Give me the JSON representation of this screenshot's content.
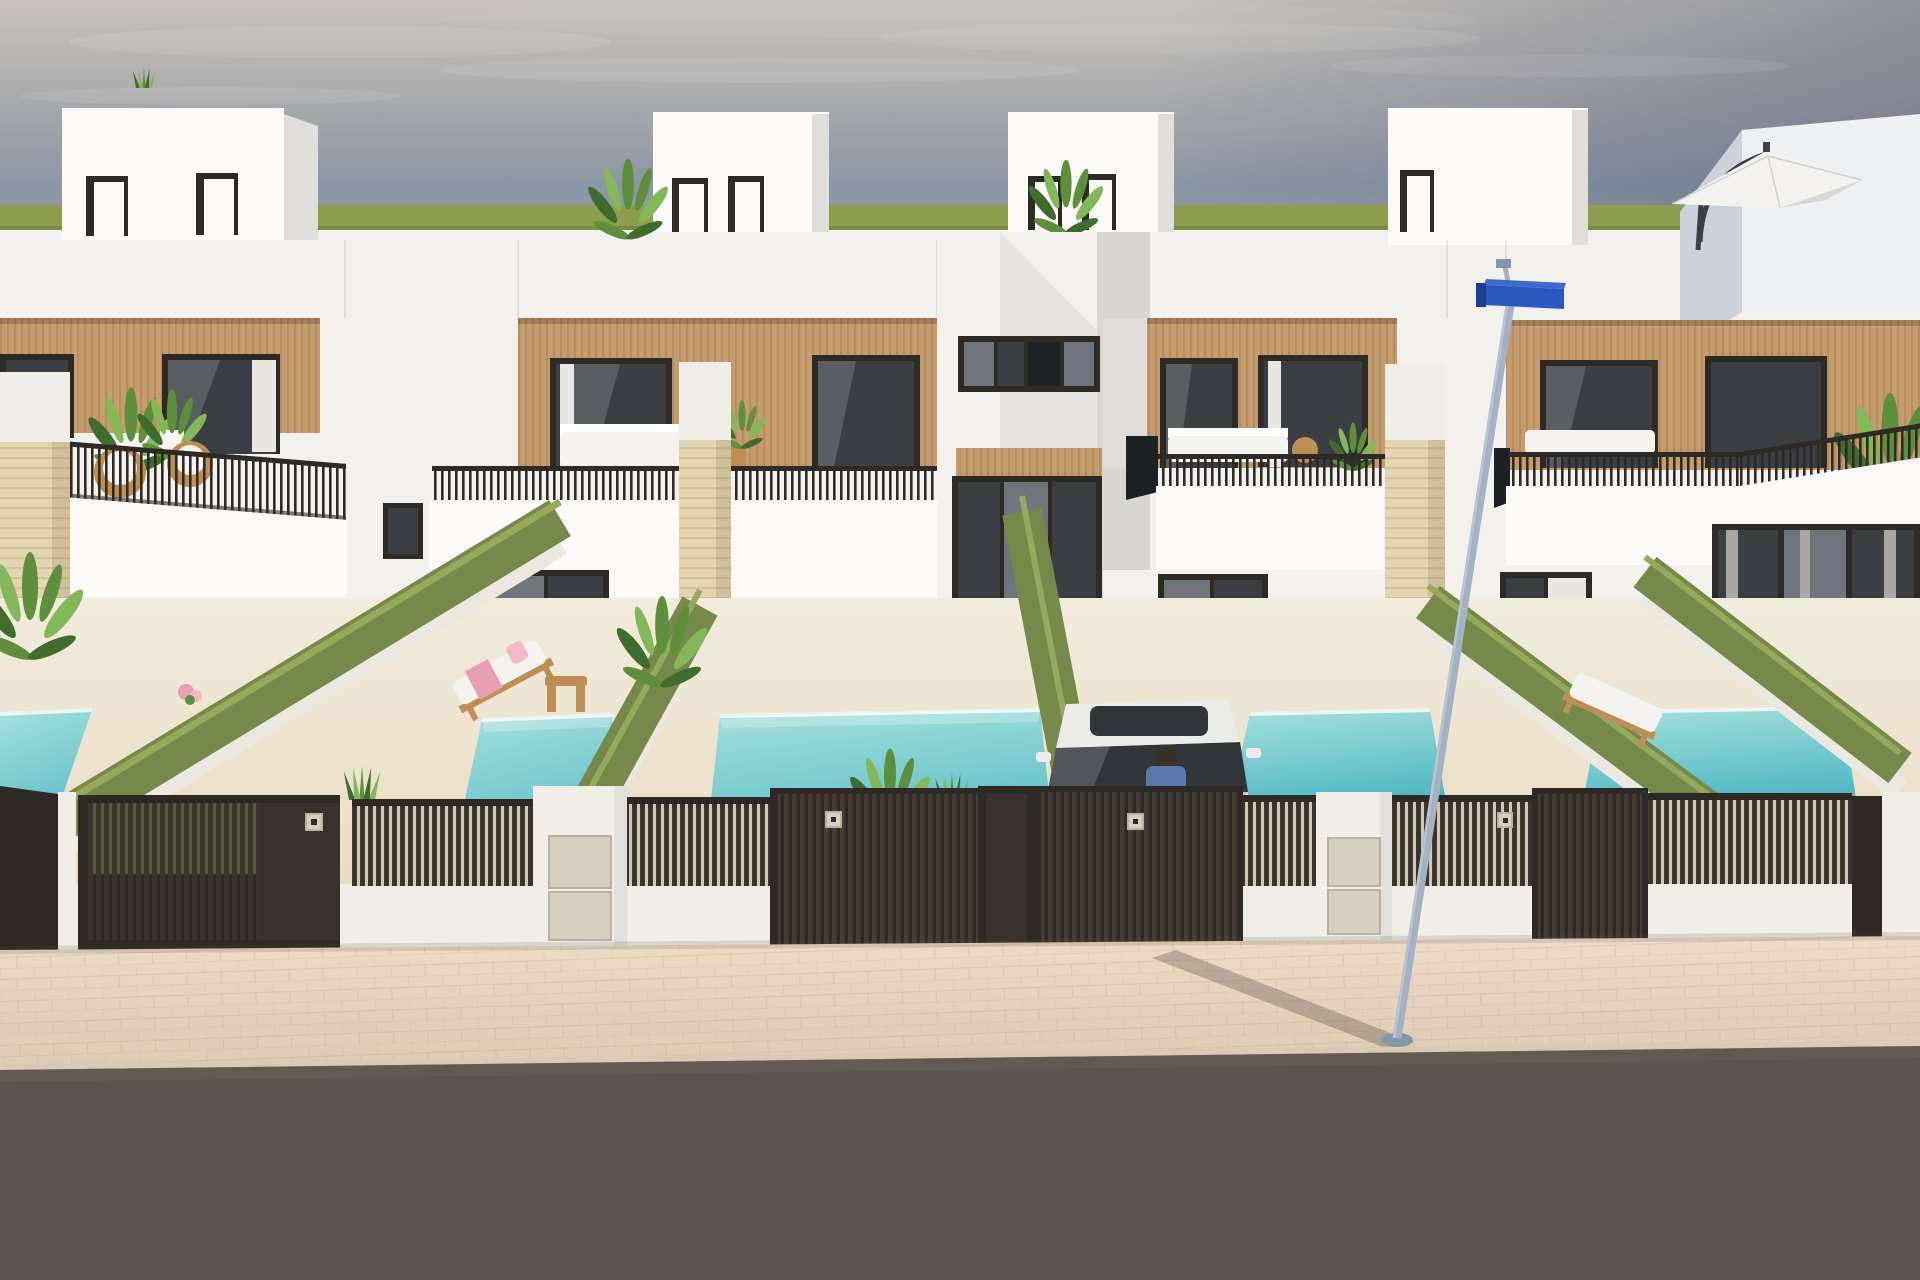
{
  "scene": {
    "type": "architectural-3d-render",
    "subject": "row of modern two-storey white townhouses with wood-clad upper floors, private plunge pools, green hedge walls, dark slat street gates, sidewalk and road in foreground",
    "objects": {
      "townhouses": 4,
      "penthouse_roof_boxes": 4,
      "pools": 5,
      "hedge_walls": 5,
      "stone_pillars": 3,
      "gates": 4,
      "meter_pillars": 2,
      "sun_loungers": 2,
      "car": "white compact with driver",
      "street_lamp": "leaning pole with blue luminaire",
      "umbrella": "white cantilever parasol on right roof terrace"
    }
  },
  "palette": {
    "sky_top": "#c8c3bc",
    "sky_mid": "#a9aaad",
    "sky_low": "#8b95a3",
    "sky_horizon": "#98a1ac",
    "sky_shade": "#4e5a72",
    "cloud": "#eae6e1",
    "grass": "#8d9c4f",
    "grass_dark": "#788c3e",
    "wall": "#f3f1ee",
    "wall_bright": "#fbfaf8",
    "wall_shade": "#e0deda",
    "bay_shade": "#d8d6d3",
    "bulk_face": "#eef0f3",
    "bulk_shade": "#ccd2dc",
    "wood": "#c49c6e",
    "wood_stripe": "#a57e52",
    "frame": "#2e2b27",
    "glass": "#6f757c",
    "glass_dark": "#3b3f44",
    "curtain": "#e9e7e2",
    "curtain_gray": "#a9a7a4",
    "trav": "#e3d5b1",
    "trav_line": "#c9b892",
    "hedge": "#75894a",
    "hedge_hi": "#95a95c",
    "hedge_wall": "#ece8df",
    "pool_hi": "#a7e0dd",
    "pool_lo": "#52b9c4",
    "pool_edge": "#e9f6f3",
    "patio": "#f2ebdc",
    "patio_warm": "#e8dbc2",
    "fence": "#2e2924",
    "fence_slat": "#3b342d",
    "fence_slat_lit": "#463d35",
    "fence_bg": "#cfc8ba",
    "fence_green_bg": "#77855a",
    "pillar_white": "#f1eee8",
    "meter": "#d6cec1",
    "sidewalk": "#ecdcc6",
    "paver": "#c8a87f",
    "road": "#5b534e",
    "curb": "#dbcab3",
    "car": "#ebebe9",
    "car_shade": "#d6d6d4",
    "car_glass": "#32363b",
    "person": "#5a78a8",
    "pole": "#a3b1c3",
    "pole_dark": "#8595a9",
    "lamp_blue": "#2a57c0",
    "lamp_blue_dark": "#1d3f90",
    "umbrella": "#f3f2ef",
    "umbrella_shade": "#d8d8d4",
    "metal_dark": "#3c4046",
    "cushion": "#f4f3f0",
    "wood_furn": "#bf8e55",
    "towel": "#e89fb1",
    "towel_hi": "#f2bac6",
    "amber": "#d9a93e",
    "leaf": "#5d8f3d",
    "leaf_dark": "#406c2d",
    "leaf_light": "#82b857",
    "pot": "#f6f5f2",
    "shadow": "#4a4038"
  }
}
